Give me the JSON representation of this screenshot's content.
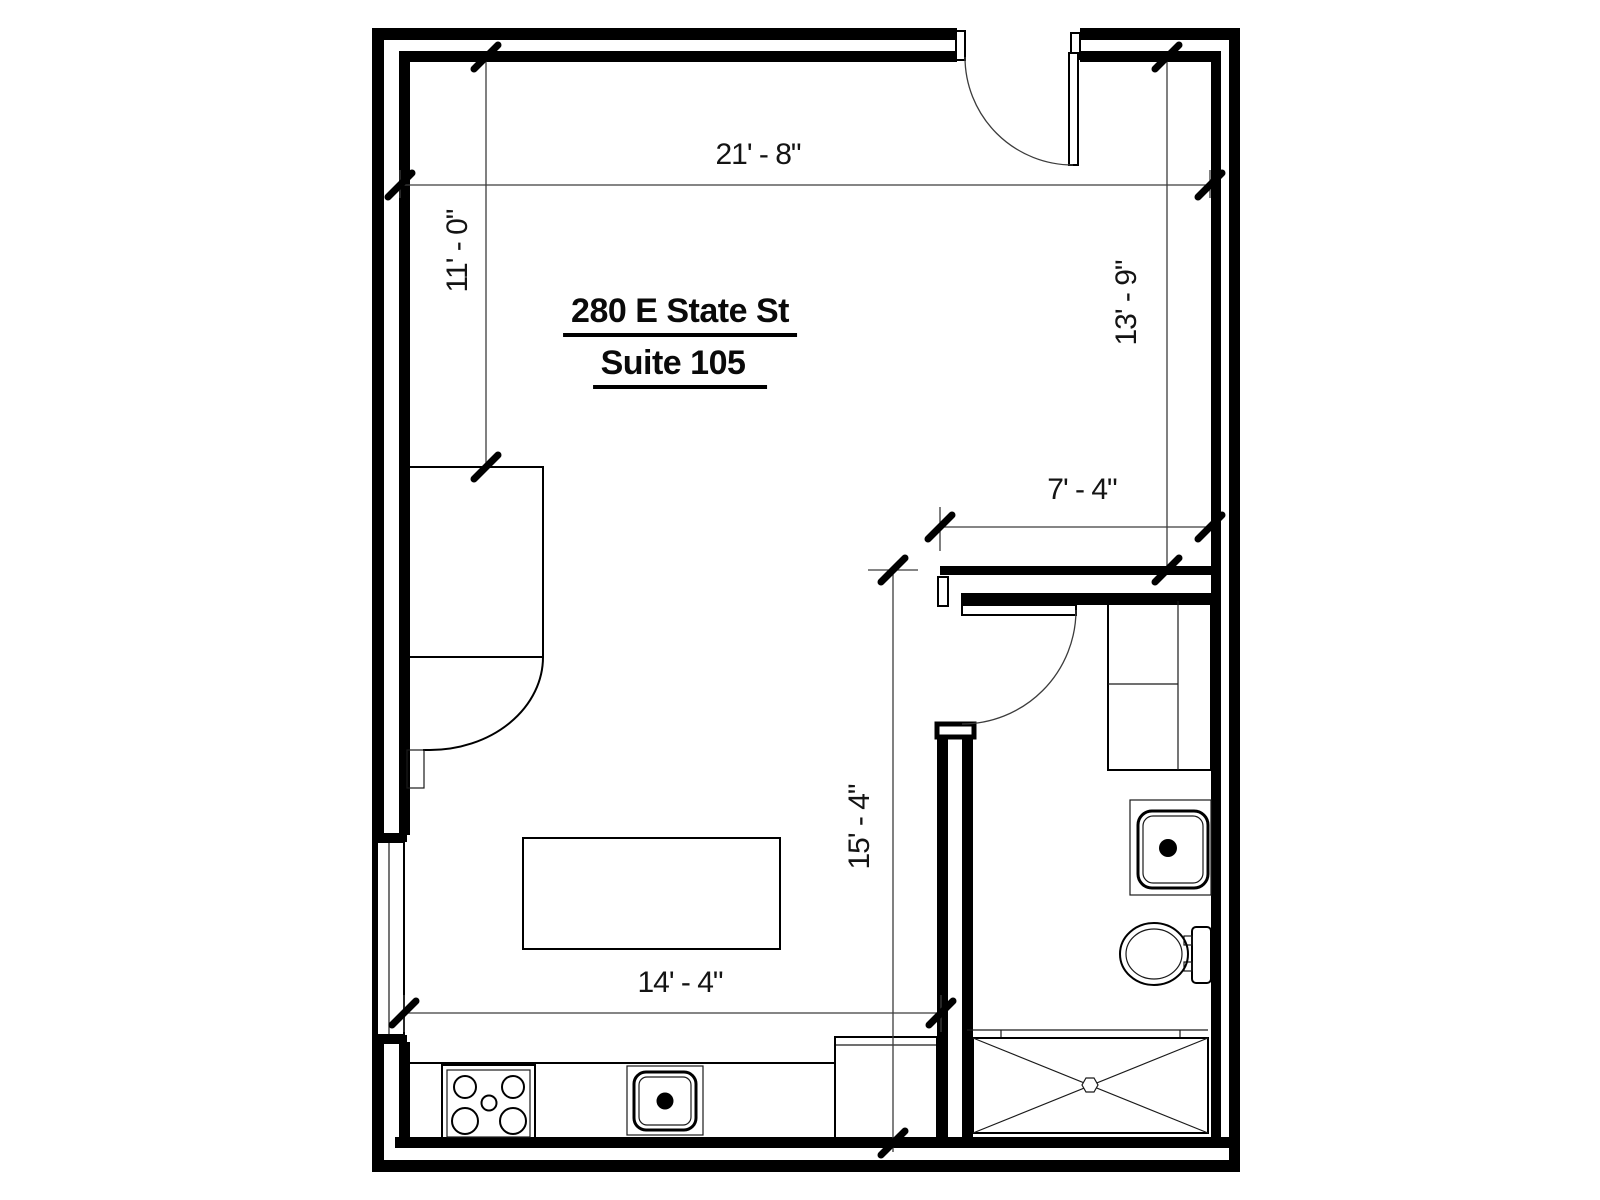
{
  "page": {
    "background_color": "#ffffff",
    "line_color": "#000000"
  },
  "title": {
    "line1": "280 E State St",
    "line2": "Suite 105"
  },
  "dimensions": {
    "top_width": "21' - 8\"",
    "upper_left_height": "11' - 0\"",
    "upper_right_height": "13' - 9\"",
    "bath_hall_width": "7' - 4\"",
    "lower_right_height": "15' - 4\"",
    "kitchen_width": "14' - 4\""
  },
  "icons": {
    "reception_desk": "reception-desk",
    "island_table": "island-table",
    "kitchen_counter": "kitchen-counter",
    "range_cooktop": "range-cooktop-icon",
    "kitchen_sink": "kitchen-sink-icon",
    "base_cabinet": "base-cabinet",
    "entry_door": "entry-door-swing-icon",
    "bathroom_door": "bathroom-door-swing-icon",
    "window": "window-icon",
    "vanity_cabinet": "vanity-cabinet",
    "bathroom_sink": "bathroom-sink-icon",
    "toilet": "toilet-icon",
    "shower": "shower-pan-icon"
  }
}
